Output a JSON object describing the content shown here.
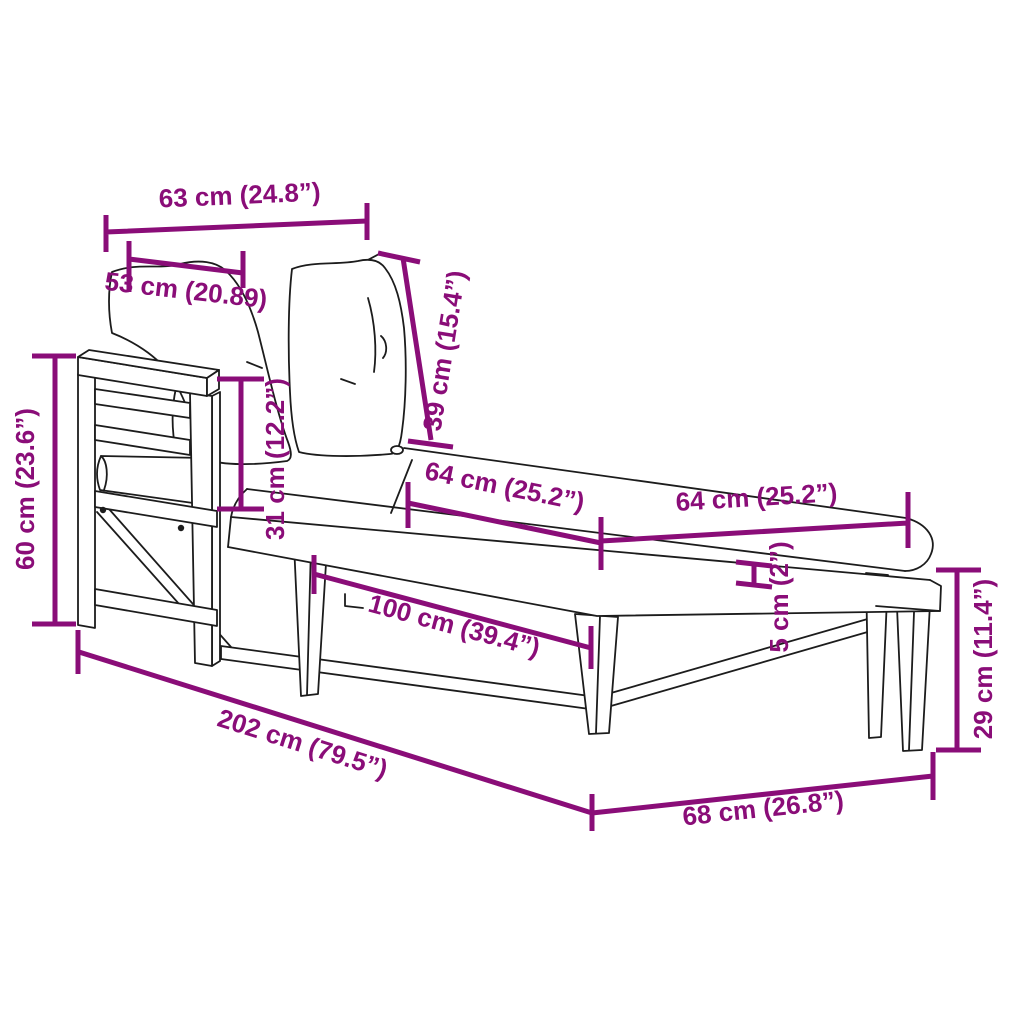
{
  "colors": {
    "dimension": "#8a0d78",
    "outline": "#1c1c1c",
    "background": "#ffffff"
  },
  "dims": {
    "backrest_width": "63 cm (24.8”)",
    "pillow_width": "53 cm (20.89)",
    "backrest_height": "39 cm (15.4”)",
    "backrest_to_seat": "31 cm (12.2”)",
    "side_frame_height": "60 cm (23.6”)",
    "cushion_section_front": "64 cm (25.2”)",
    "cushion_section_end": "64 cm (25.2”)",
    "cushion_thickness": "5 cm (2”)",
    "seat_length": "100 cm (39.4”)",
    "total_length": "202 cm (79.5”)",
    "width": "68 cm (26.8”)",
    "leg_height": "29 cm (11.4”)"
  }
}
